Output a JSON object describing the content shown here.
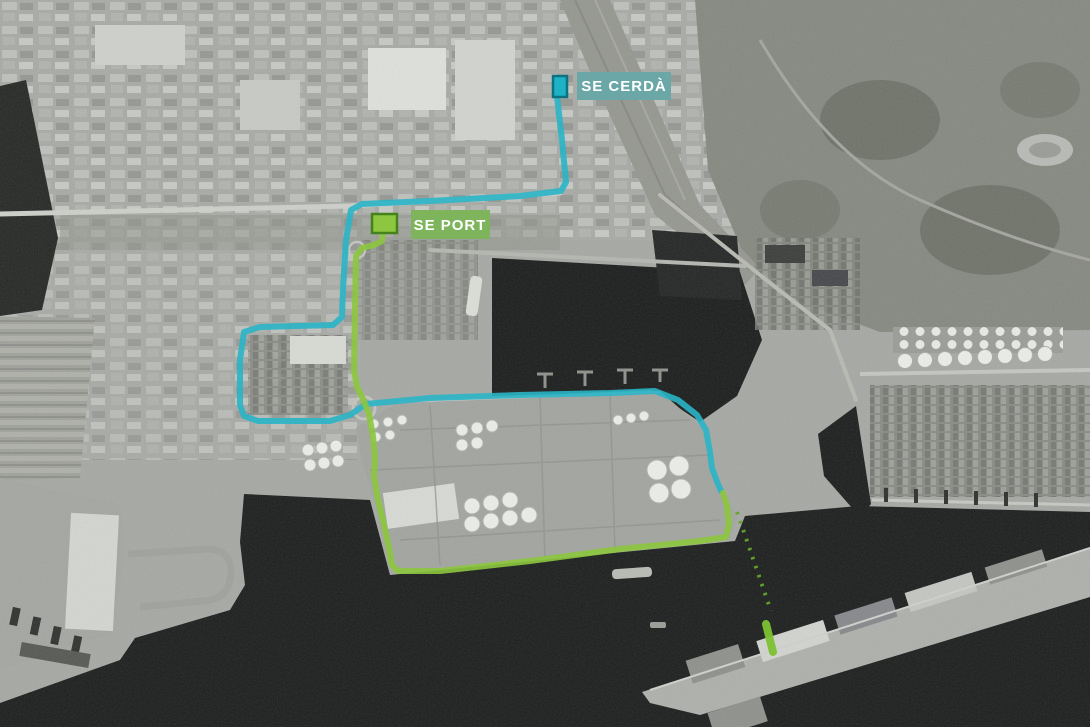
{
  "map": {
    "description": "Grayscale aerial photo of the Port de Barcelona / Zona Franca area with two substation markers and their connection routes",
    "labels": [
      {
        "id": "se-cerda",
        "text": "SE CERDÀ",
        "bg": "#6BA7A7",
        "fg": "#FFFFFF"
      },
      {
        "id": "se-port",
        "text": "SE PORT",
        "bg": "#7EB55C",
        "fg": "#FFFFFF"
      }
    ],
    "markers": [
      {
        "id": "se-cerda-marker",
        "color": "#1DB3C4",
        "border": "#0D7182"
      },
      {
        "id": "se-port-marker",
        "color": "#8DC63F",
        "border": "#44831C"
      }
    ],
    "routes": [
      {
        "id": "route-se-cerda",
        "name": "SE Cerdà connection",
        "color": "#2AB5C6",
        "width": 6,
        "opacity": 0.9,
        "style": "solid",
        "points": [
          [
            557,
            96
          ],
          [
            562,
            140
          ],
          [
            566,
            182
          ],
          [
            561,
            191
          ],
          [
            520,
            196
          ],
          [
            430,
            201
          ],
          [
            362,
            204
          ],
          [
            351,
            210
          ],
          [
            346,
            240
          ],
          [
            343,
            290
          ],
          [
            342,
            317
          ],
          [
            333,
            325
          ],
          [
            260,
            327
          ],
          [
            244,
            332
          ],
          [
            240,
            360
          ],
          [
            240,
            405
          ],
          [
            244,
            416
          ],
          [
            258,
            421
          ],
          [
            330,
            421
          ],
          [
            350,
            415
          ],
          [
            366,
            404
          ],
          [
            430,
            398
          ],
          [
            520,
            395
          ],
          [
            610,
            393
          ],
          [
            655,
            391
          ],
          [
            678,
            400
          ],
          [
            697,
            415
          ],
          [
            706,
            430
          ],
          [
            710,
            452
          ],
          [
            712,
            468
          ],
          [
            718,
            484
          ],
          [
            721,
            491
          ]
        ]
      },
      {
        "id": "route-se-port",
        "name": "SE Port connection",
        "color": "#8CC63E",
        "width": 6,
        "opacity": 0.9,
        "style": "solid",
        "points": [
          [
            383,
            232
          ],
          [
            382,
            241
          ],
          [
            374,
            245
          ],
          [
            362,
            248
          ],
          [
            356,
            256
          ],
          [
            355,
            310
          ],
          [
            354,
            370
          ],
          [
            357,
            387
          ],
          [
            363,
            399
          ],
          [
            369,
            414
          ],
          [
            373,
            436
          ],
          [
            375,
            458
          ],
          [
            374,
            476
          ],
          [
            378,
            500
          ],
          [
            384,
            524
          ],
          [
            389,
            548
          ],
          [
            392,
            565
          ],
          [
            398,
            571
          ],
          [
            440,
            571
          ],
          [
            530,
            561
          ],
          [
            620,
            549
          ],
          [
            700,
            541
          ],
          [
            726,
            537
          ],
          [
            729,
            524
          ],
          [
            727,
            506
          ],
          [
            723,
            493
          ]
        ]
      },
      {
        "id": "route-submarine-dotted",
        "name": "Dotted water crossing",
        "color": "#63A32A",
        "width": 4,
        "opacity": 0.95,
        "style": "dotted",
        "points": [
          [
            737,
            512
          ],
          [
            771,
            611
          ]
        ]
      },
      {
        "id": "route-pier-segment",
        "name": "Pier quay segment",
        "color": "#7DC133",
        "width": 8,
        "opacity": 0.95,
        "style": "solid",
        "points": [
          [
            766,
            624
          ],
          [
            773,
            652
          ]
        ]
      }
    ]
  }
}
